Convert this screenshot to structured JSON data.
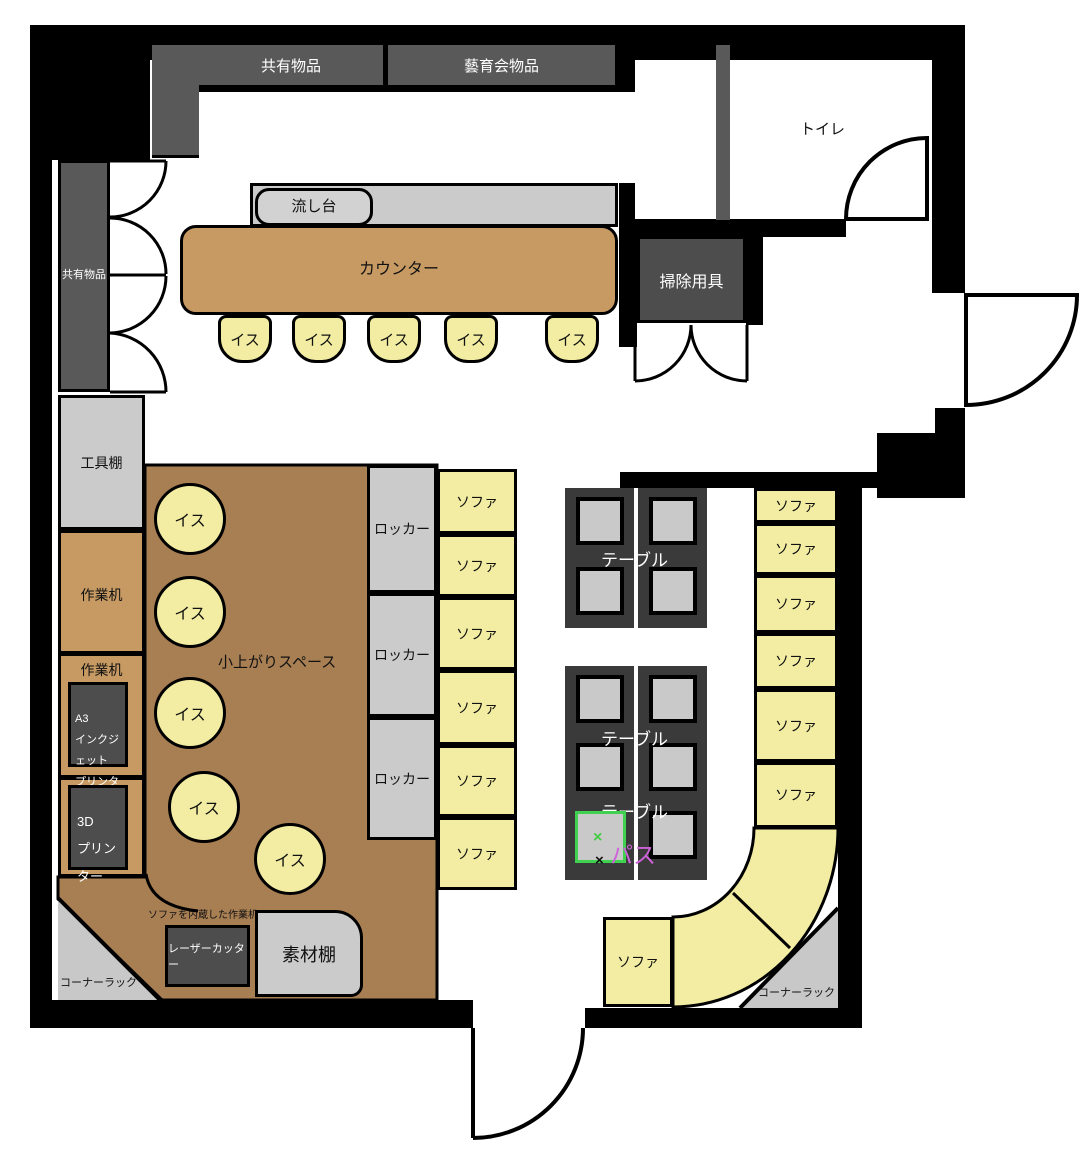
{
  "colors": {
    "wall": "#000000",
    "shelf_dark": "#595959",
    "box_dark": "#4D4D4D",
    "gray_light": "#CBCBCB",
    "table_frame": "#3A3A3A",
    "counter_tan": "#C79A63",
    "floor_brown": "#A87E53",
    "sofa_yellow": "#F2EDA2",
    "highlight_green": "#3FD14F",
    "pass_pink": "#CD63D8"
  },
  "shelves": {
    "top_left": "共有物品",
    "top_right": "藝育会物品",
    "left_cabinet": "共有物品"
  },
  "rooms": {
    "toilet": "トイレ",
    "cleaning": "掃除用具"
  },
  "kitchen": {
    "sink": "流し台",
    "counter": "カウンター",
    "chairs": [
      "イス",
      "イス",
      "イス",
      "イス",
      "イス"
    ]
  },
  "workshop": {
    "tool_shelf": "工具棚",
    "desk1": "作業机",
    "desk2": "作業机",
    "a3_printer": {
      "lines": [
        "A3",
        "インクジェット",
        "プリンター"
      ]
    },
    "printer_3d": {
      "lines": [
        "3D",
        "プリンター"
      ]
    },
    "laser_cutter": "レーザーカッター",
    "material_shelf": "素材棚",
    "sofa_desk": "ソファを内蔵した作業机"
  },
  "floor_space": {
    "label": "小上がりスペース",
    "chairs": [
      "イス",
      "イス",
      "イス",
      "イス",
      "イス"
    ]
  },
  "lockers": [
    "ロッカー",
    "ロッカー",
    "ロッカー"
  ],
  "sofas": {
    "left": [
      "ソファ",
      "ソファ",
      "ソファ",
      "ソファ",
      "ソファ",
      "ソファ"
    ],
    "right": [
      "ソファ",
      "ソファ",
      "ソファ",
      "ソファ",
      "ソファ",
      "ソファ"
    ],
    "corner": [
      "ソファ",
      "ソファ",
      "ソファ"
    ]
  },
  "tables": {
    "upper": "テーブル",
    "lower_a": "テーブル",
    "lower_b": "テーブル"
  },
  "pass": {
    "label": "パス",
    "mark": "×",
    "mark2": "×"
  },
  "corner_racks": {
    "left": "コーナーラック",
    "right": "コーナーラック"
  }
}
